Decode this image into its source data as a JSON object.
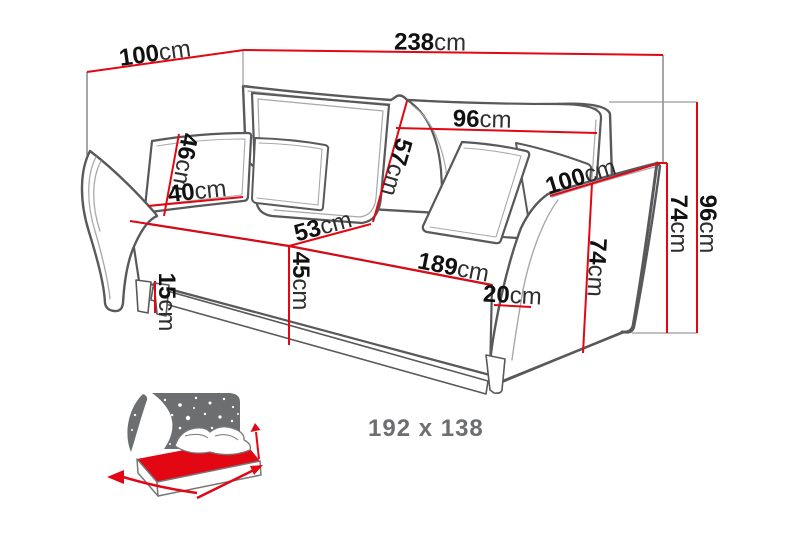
{
  "colors": {
    "dimension_red": "#e30613",
    "outline_dark": "#58595b",
    "outline_light": "#a8a8a8",
    "icon_gray": "#6d6e70",
    "label_black": "#1a1a1a",
    "background": "#ffffff"
  },
  "dimensions": {
    "top_depth": {
      "value": "100",
      "unit": "cm"
    },
    "total_width": {
      "value": "238",
      "unit": "cm"
    },
    "cushion_height": {
      "value": "46",
      "unit": "cm"
    },
    "cushion_width": {
      "value": "40",
      "unit": "cm"
    },
    "backrest_height": {
      "value": "57",
      "unit": "cm"
    },
    "backrest_width": {
      "value": "96",
      "unit": "cm"
    },
    "seat_depth": {
      "value": "53",
      "unit": "cm"
    },
    "seat_height": {
      "value": "45",
      "unit": "cm"
    },
    "seat_width": {
      "value": "189",
      "unit": "cm"
    },
    "floor_clearance": {
      "value": "15",
      "unit": "cm"
    },
    "armrest_width": {
      "value": "20",
      "unit": "cm"
    },
    "armrest_depth": {
      "value": "100",
      "unit": "cm"
    },
    "armrest_front_height": {
      "value": "74",
      "unit": "cm"
    },
    "armrest_height": {
      "value": "74",
      "unit": "cm"
    },
    "total_height": {
      "value": "96",
      "unit": "cm"
    }
  },
  "sleeping_area": {
    "label": "192 x 138"
  }
}
